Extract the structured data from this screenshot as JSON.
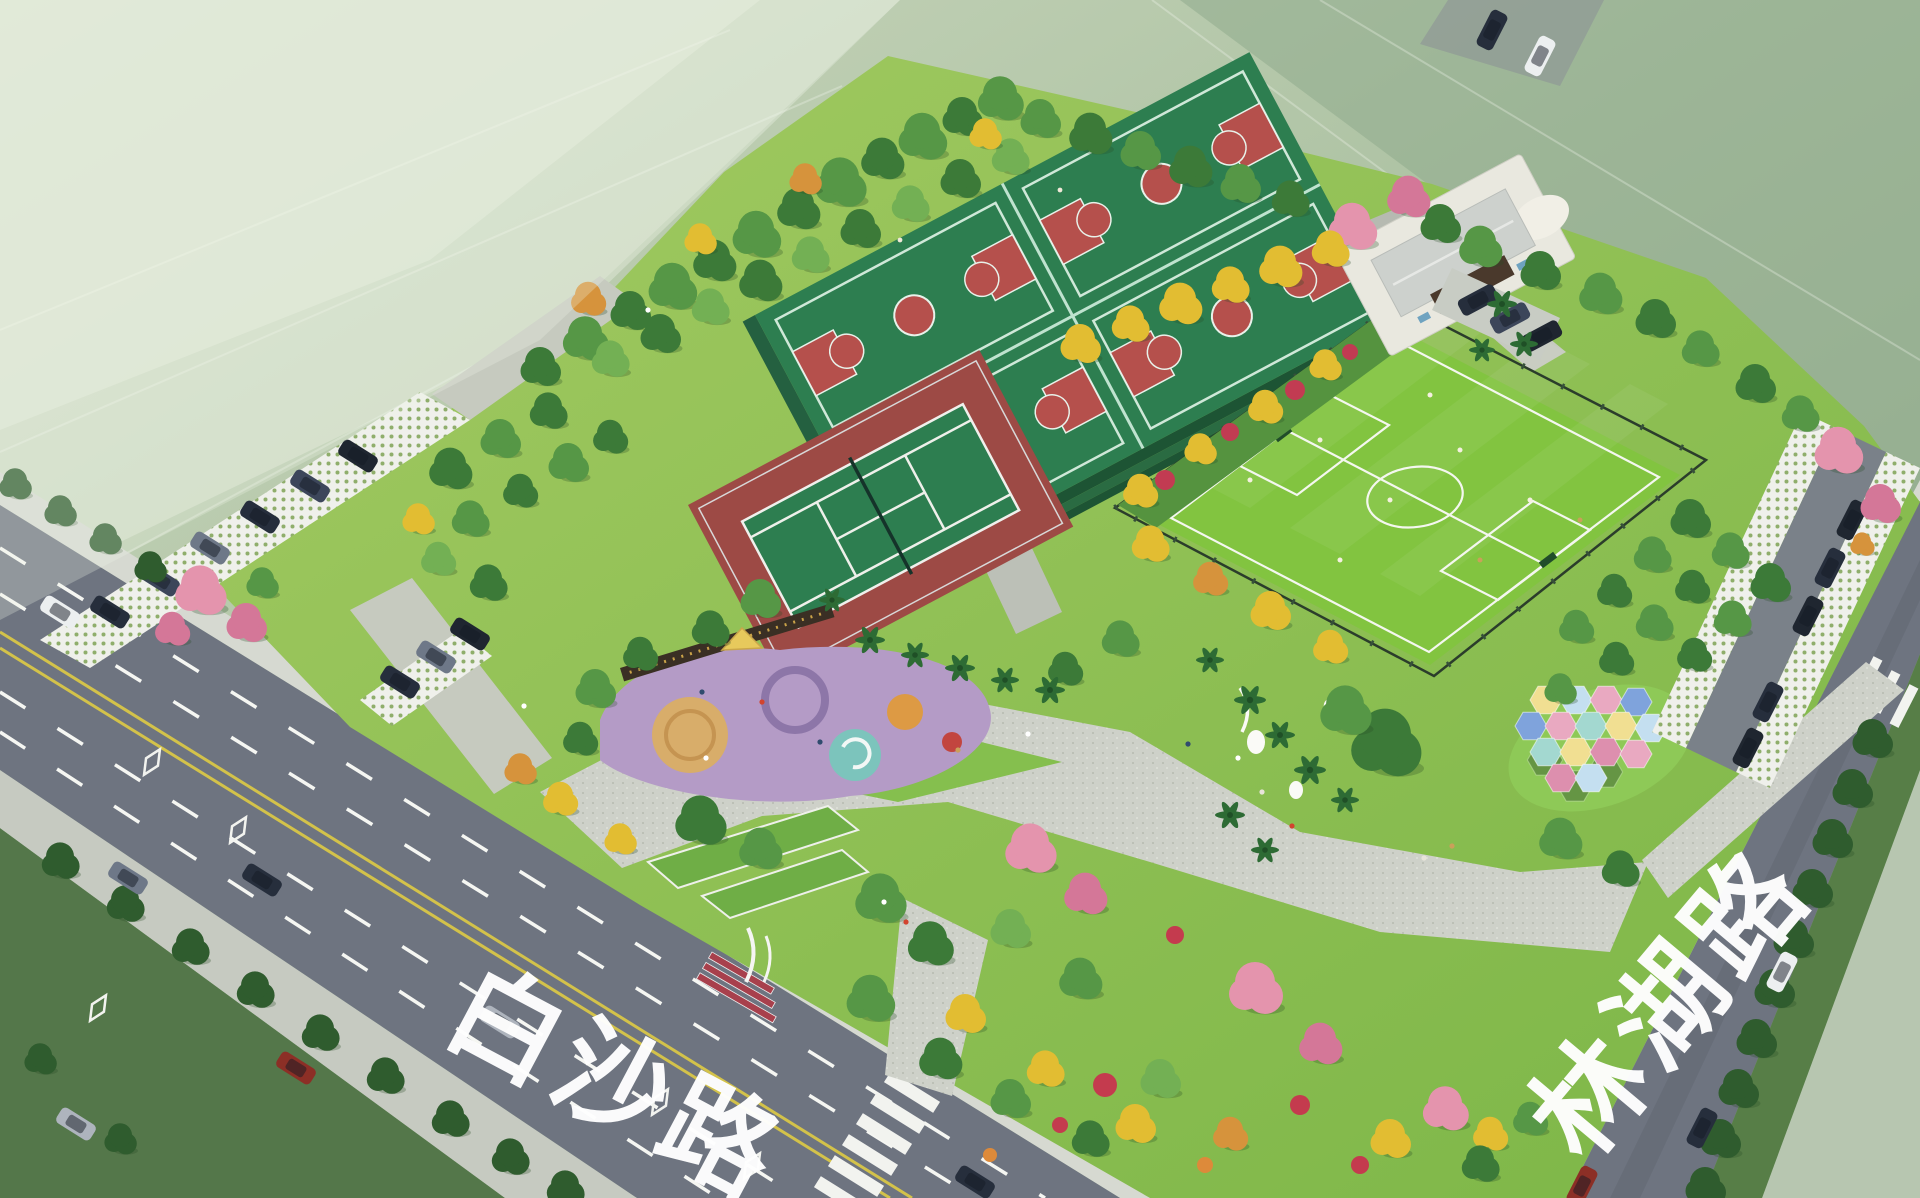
{
  "road_labels": {
    "bottom_road": "白沙路",
    "right_road": "林湖路"
  },
  "palette": {
    "asphalt": "#6e7480",
    "lane_yellow": "#d3c24a",
    "field_green": "#82c440",
    "court_green": "#2d7e50",
    "court_red": "#b5504c",
    "tennis_apron": "#9d4a45",
    "playground_purple": "#b49bc6",
    "paving_gray": "#cdd0c8",
    "hex_blue": "#7fa3dc",
    "hex_pink": "#e9a9c1",
    "hex_yellow": "#f1df92",
    "hex_teal": "#a3d8d0",
    "hex_sky": "#c4dff0",
    "hex_rose": "#dd8fae"
  }
}
